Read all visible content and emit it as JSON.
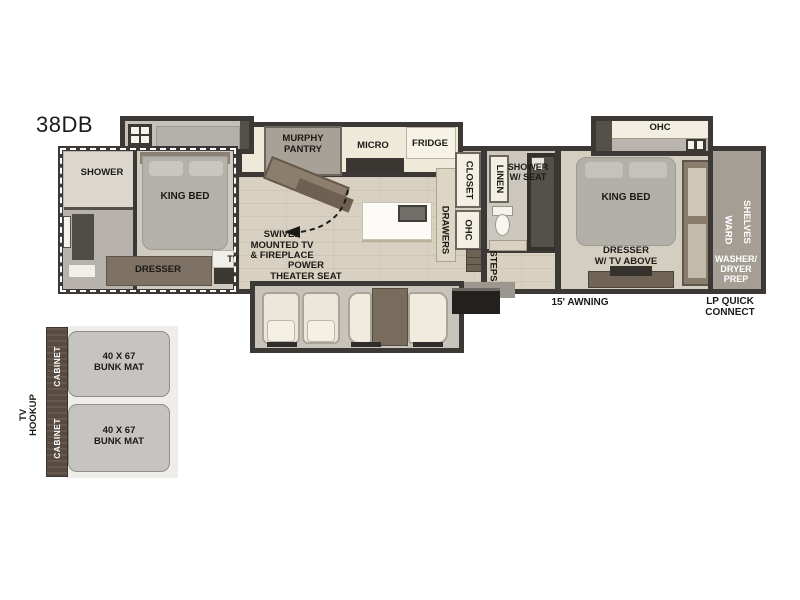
{
  "colors": {
    "wall": "#3b3835",
    "wood_floor": "#d8d1c2",
    "carpet": "#d0cbc0",
    "cream_cabinet": "#f2eee1",
    "brown_furniture": "#7d7163",
    "dark_brown_cabinet": "#584a3f",
    "mattress_gray": "#b4b1ab",
    "bunk_mat_gray": "#c6c4c0"
  },
  "title": {
    "model": "38DB"
  },
  "front_bedroom": {
    "shower": "SHOWER",
    "king_bed": "KING BED",
    "dresser": "DRESSER",
    "tv": "TV"
  },
  "kitchen": {
    "murphy_pantry": "MURPHY\nPANTRY",
    "micro": "MICRO",
    "fridge": "FRIDGE",
    "swivel_tv": "SWIVEL\nMOUNTED TV\n& FIREPLACE",
    "closet": "CLOSET",
    "drawers": "DRAWERS",
    "ohc": "OHC"
  },
  "living": {
    "power_theater_seat": "POWER\nTHEATER SEAT"
  },
  "bathroom": {
    "linen": "LINEN",
    "shower_w_seat": "SHOWER\nW/ SEAT",
    "steps": "STEPS"
  },
  "rear_bedroom": {
    "ohc": "OHC",
    "king_bed": "KING BED",
    "dresser": "DRESSER\nW/ TV ABOVE",
    "shelves": "SHELVES",
    "ward": "WARD",
    "washer_dryer_prep": "WASHER/\nDRYER\nPREP"
  },
  "exterior": {
    "awning": "15' AWNING",
    "lp_quick_connect": "LP QUICK\nCONNECT"
  },
  "bunk_room": {
    "tv_hookup": "TV\nHOOKUP",
    "cabinet_top": "CABINET",
    "cabinet_bottom": "CABINET",
    "bunk_mat_top": "40 X 67\nBUNK MAT",
    "bunk_mat_bottom": "40 X 67\nBUNK MAT"
  }
}
